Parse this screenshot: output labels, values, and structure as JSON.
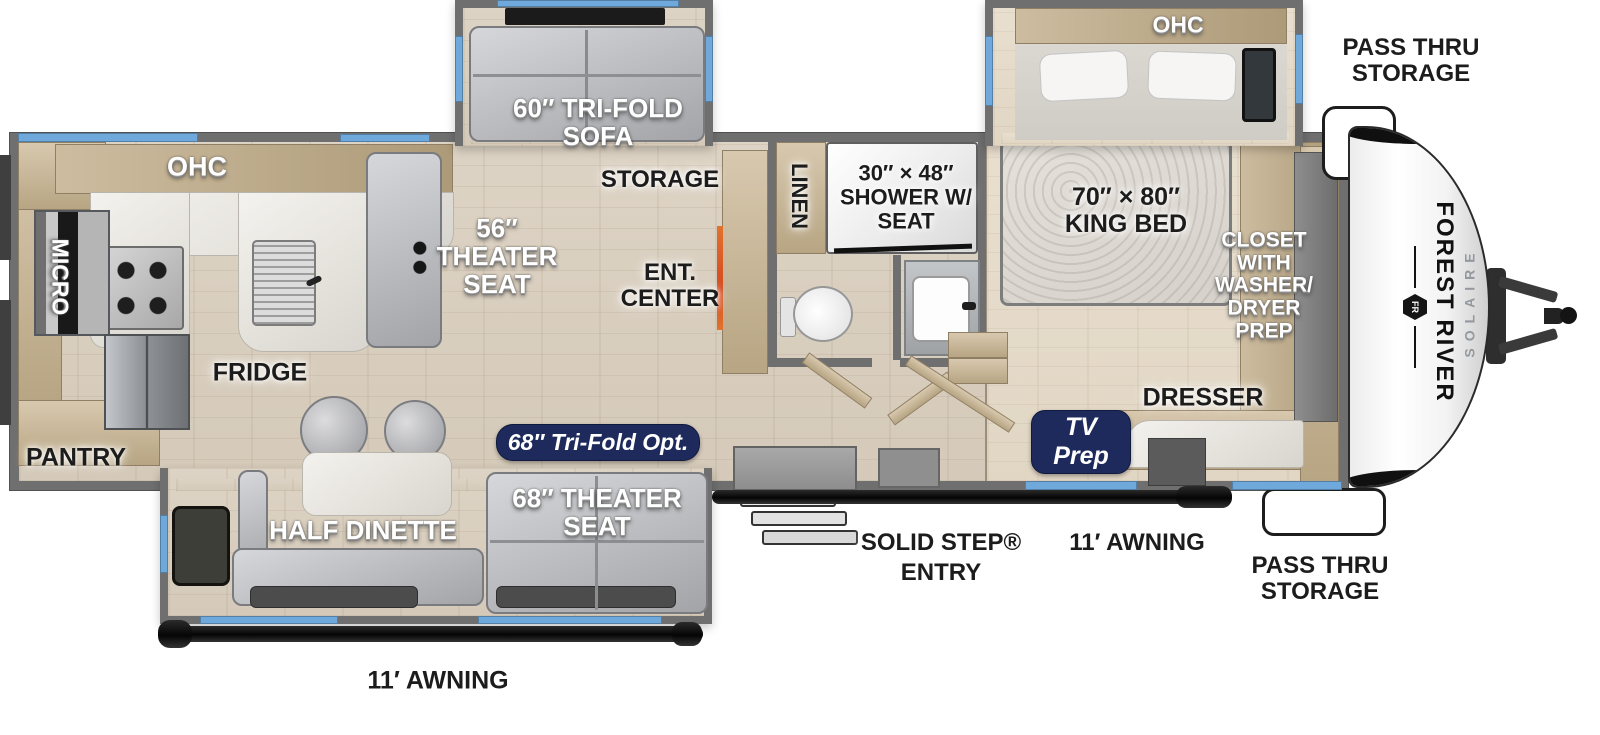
{
  "diagram": {
    "title": "Travel trailer floor plan",
    "brand": {
      "manufacturer": "FOREST RIVER",
      "model": "SOLAIRE",
      "logo_monogram": "FR"
    },
    "labels": {
      "kitchen_ohc": "OHC",
      "micro": "MICRO",
      "fridge": "FRIDGE",
      "pantry": "PANTRY",
      "tri_fold_sofa": "60″ TRI-FOLD\nSOFA",
      "storage": "STORAGE",
      "theater_seat_56": "56″\nTHEATER\nSEAT",
      "ent_center": "ENT.\nCENTER",
      "linen": "LINEN",
      "shower": "30″ × 48″\nSHOWER W/\nSEAT",
      "bedroom_ohc": "OHC",
      "king_bed": "70″ × 80″\nKING BED",
      "closet": "CLOSET\nWITH\nWASHER/\nDRYER\nPREP",
      "dresser": "DRESSER",
      "half_dinette": "HALF DINETTE",
      "theater_seat_68": "68″ THEATER\nSEAT",
      "solid_step_entry": "SOLID STEP®\nENTRY",
      "awning_door_side": "11′ AWNING",
      "awning_camp_side": "11′ AWNING",
      "pass_thru_top": "PASS THRU\nSTORAGE",
      "pass_thru_bottom": "PASS THRU\nSTORAGE"
    },
    "badges": {
      "tri_fold_option": "68″ Tri-Fold Opt.",
      "tv_prep": "TV\nPrep"
    },
    "colors": {
      "window_blue": "#6FA9DC",
      "badge_navy": "#1E2A5C",
      "wall_gray": "#6F6F6F",
      "fireplace_orange": "#E2722E",
      "label_black": "#1C1C1C",
      "label_white": "#FFFFFF"
    }
  }
}
